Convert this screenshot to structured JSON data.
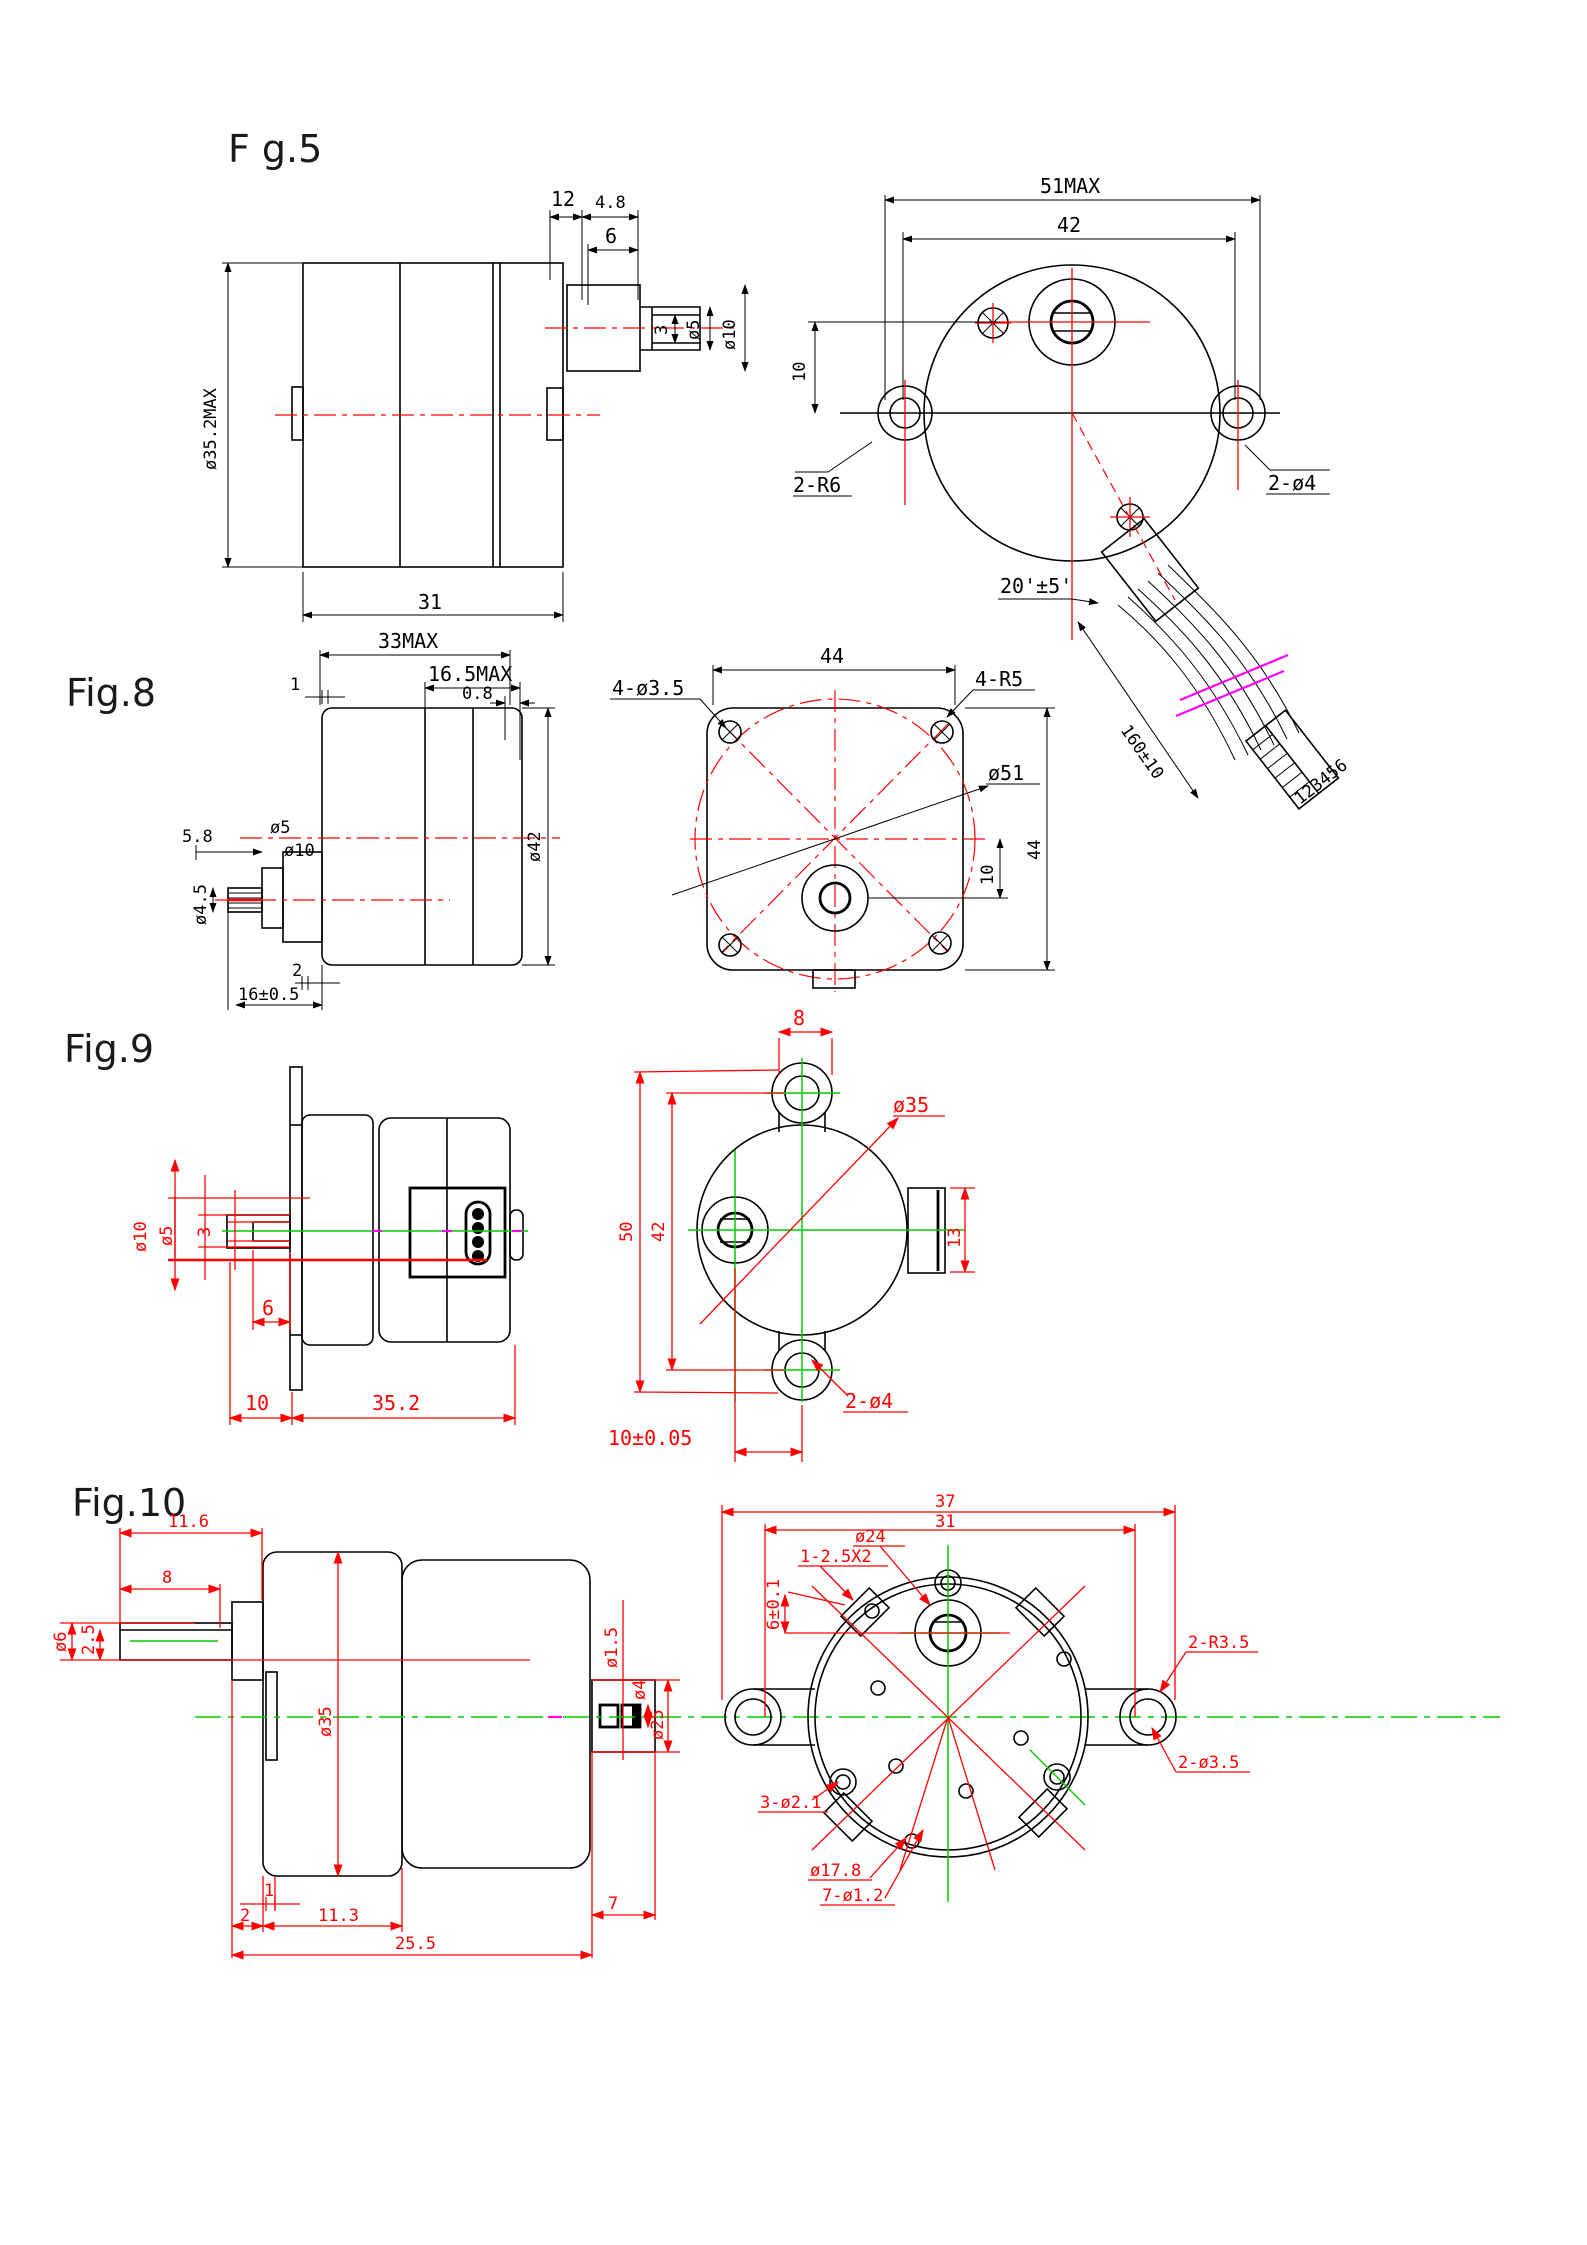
{
  "colors": {
    "outline_black": "#000000",
    "dimension_red": "#ff0000",
    "centerline_green": "#00cc00",
    "accent_magenta": "#ff00ff"
  },
  "fig5": {
    "title": "F g.5",
    "d12": "12",
    "d48": "4.8",
    "d6": "6",
    "d3": "3",
    "dia5": "ø5",
    "dia10": "ø10",
    "dia352": "ø35.2MAX",
    "d31": "31",
    "d51": "51MAX",
    "d42": "42",
    "d10": "10",
    "r6": "2-R6",
    "dia4": "2-ø4",
    "angle": "20'±5'",
    "cable": "160±10",
    "pins": "123456"
  },
  "fig8": {
    "title": "Fig.8",
    "d33": "33MAX",
    "d165": "16.5MAX",
    "d08": "0.8",
    "d1": "1",
    "d58": "5.8",
    "dia5": "ø5",
    "dia10": "ø10",
    "dia45": "ø4.5",
    "dia42": "ø42",
    "d2": "2",
    "d16": "16±0.5",
    "d44t": "44",
    "holes": "4-ø3.5",
    "r5": "4-R5",
    "dia51": "ø51",
    "d44r": "44",
    "d10": "10"
  },
  "fig9": {
    "title": "Fig.9",
    "dia10": "ø10",
    "dia5": "ø5",
    "d3": "3",
    "d6": "6",
    "d10": "10",
    "d352": "35.2",
    "d8": "8",
    "d50": "50",
    "d42": "42",
    "dia35": "ø35",
    "d13": "13",
    "holes": "2-ø4",
    "d1005": "10±0.05"
  },
  "fig10": {
    "title": "Fig.10",
    "d116": "11.6",
    "d8": "8",
    "dia6": "ø6",
    "d25": "2.5",
    "dia35": "ø35",
    "d1": "1",
    "d2": "2",
    "d113": "11.3",
    "dia15": "ø1.5",
    "dia4": "ø4",
    "dia25": "ø25",
    "d7": "7",
    "d255": "25.5",
    "d37": "37",
    "d31": "31",
    "dia24": "ø24",
    "slots": "1-2.5X2",
    "d601": "6±0.1",
    "r35": "2-R3.5",
    "dia35h": "2-ø3.5",
    "holes3": "3-ø2.1",
    "dia178": "ø17.8",
    "holes7": "7-ø1.2"
  }
}
